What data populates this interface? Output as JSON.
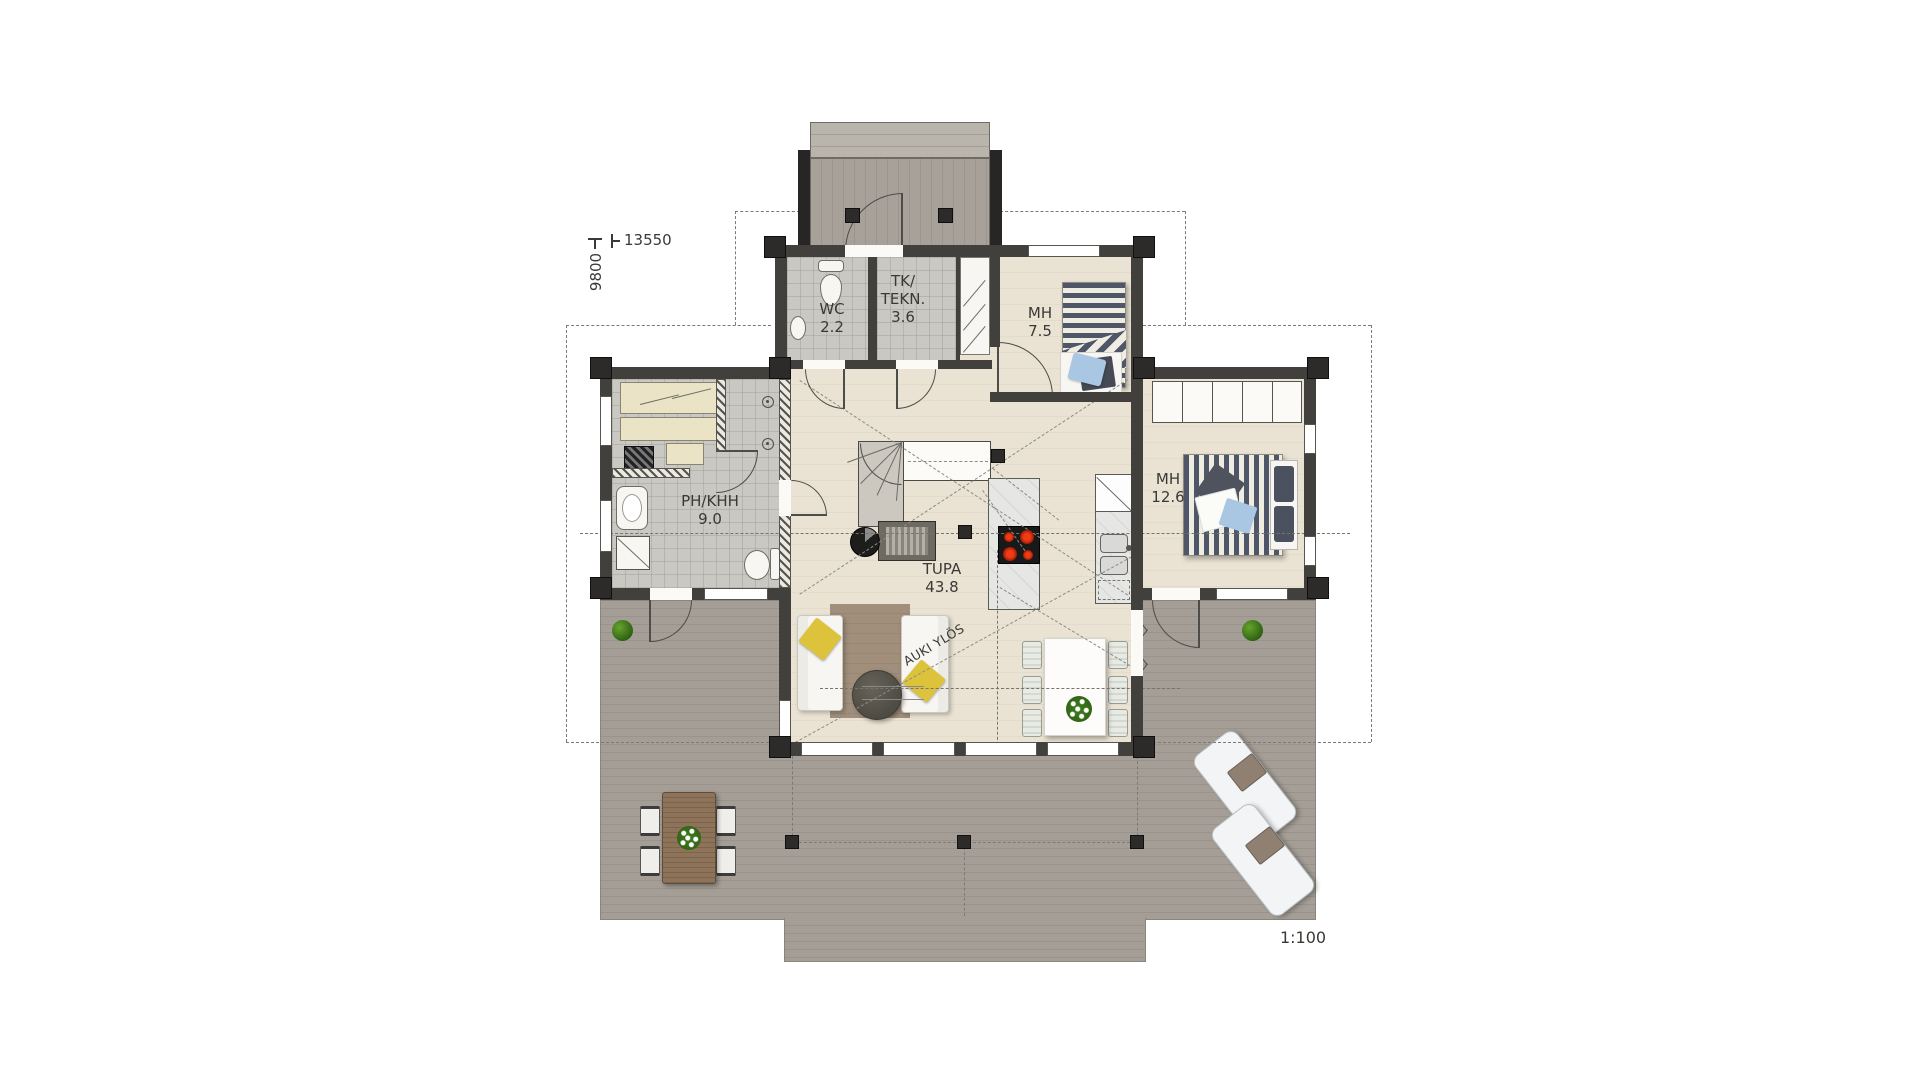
{
  "annotations": {
    "dim_width": "13550",
    "dim_height": "9800",
    "scale": "1:100",
    "stair_note": "AUKI YLÖS"
  },
  "rooms": {
    "wc": {
      "name": "WC",
      "area": "2.2"
    },
    "tk": {
      "name1": "TK/",
      "name2": "TEKN.",
      "area": "3.6"
    },
    "mh_small": {
      "name": "MH",
      "area": "7.5"
    },
    "mh_large": {
      "name": "MH",
      "area": "12.6"
    },
    "ph": {
      "name": "PH/KHH",
      "area": "9.0"
    },
    "tupa": {
      "name": "TUPA",
      "area": "43.8"
    }
  },
  "icons": {
    "toilet": "oval-bowl",
    "washbasin": "rounded-rect",
    "shower": "circle-dot",
    "single-bed": "striped-rect",
    "double-bed": "striped-rect",
    "wardrobe": "divided-rect",
    "sofa": "white-rect",
    "coffee-table": "dark-circle",
    "dining-table": "white-rect",
    "outdoor-table": "wood-rect",
    "sun-lounger": "rounded-rect",
    "plant": "green-circle",
    "wood-stove": "dark-circle",
    "fireplace": "hatched-rect",
    "cooktop": "black-rect-red-burners",
    "fridge": "crossed-square",
    "washing-machine": "crossed-square",
    "sink": "double-basin",
    "sauna-heater": "hatched-square",
    "stairs": "winder-quarter-turn"
  },
  "colors": {
    "wall": "#41403d",
    "deck": "#a49e96",
    "wood_floor": "#e9e2d2",
    "tile_floor": "#cac8c3",
    "stripe_navy": "#4f5668",
    "pillow_yellow": "#ddc33c",
    "pillow_blue": "#a9c6e2",
    "rug": "#a18f7c",
    "sauna_bench": "#eae3c6",
    "burner_red": "#d92810",
    "plant_green": "#3e7a1e",
    "linework": "#4c4c48",
    "dashed_line": "#7a7a76"
  }
}
